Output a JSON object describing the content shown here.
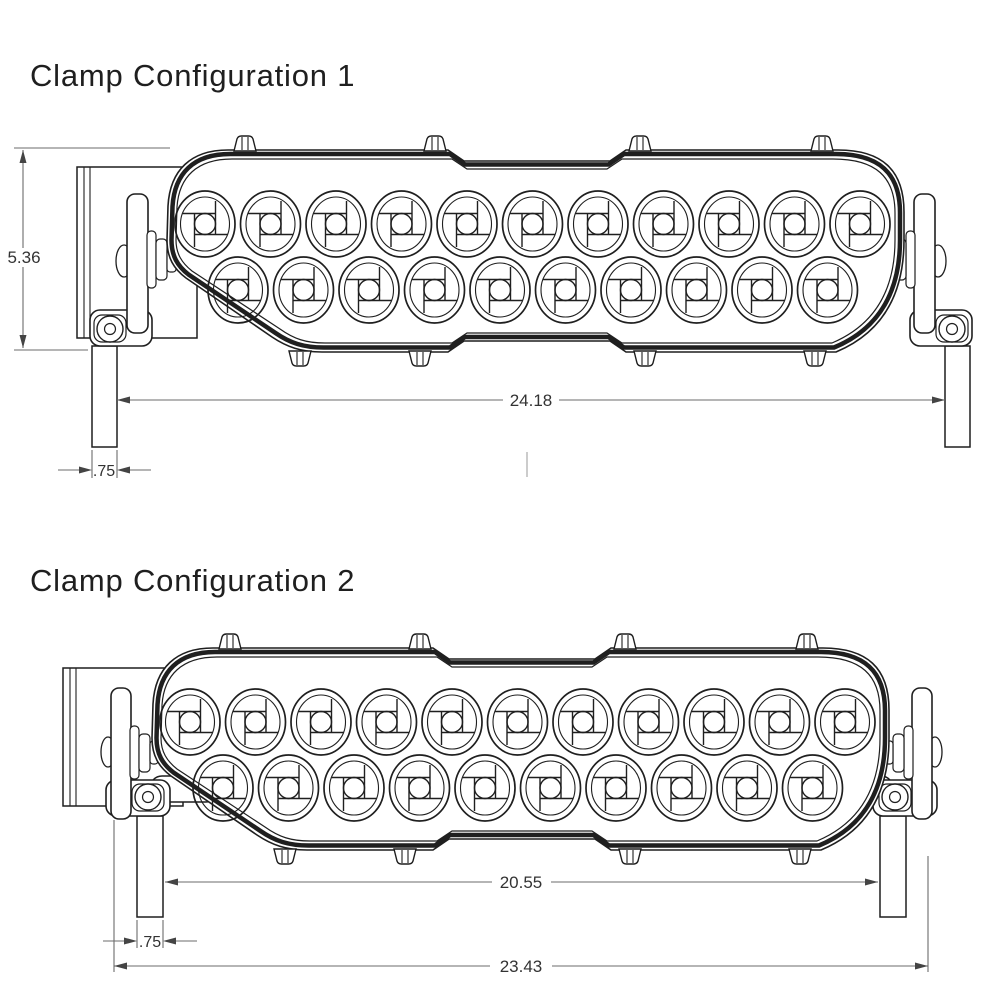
{
  "configurations": [
    {
      "title": "Clamp Configuration 1",
      "dimensions": [
        {
          "name": "bar-height",
          "value": "5.36"
        },
        {
          "name": "clamp-inner-span",
          "value": "24.18"
        },
        {
          "name": "leg-width",
          "value": ".75"
        }
      ]
    },
    {
      "title": "Clamp Configuration 2",
      "dimensions": [
        {
          "name": "clamp-inner-span",
          "value": "20.55"
        },
        {
          "name": "leg-width",
          "value": ".75"
        },
        {
          "name": "overall-span",
          "value": "23.43"
        }
      ]
    }
  ],
  "drawing": {
    "lenses_top_row": 11,
    "lenses_bottom_row": 10,
    "line_color": "#1f1f1f",
    "dim_line_color": "#6b6b6b",
    "dim_text_color": "#333333"
  }
}
